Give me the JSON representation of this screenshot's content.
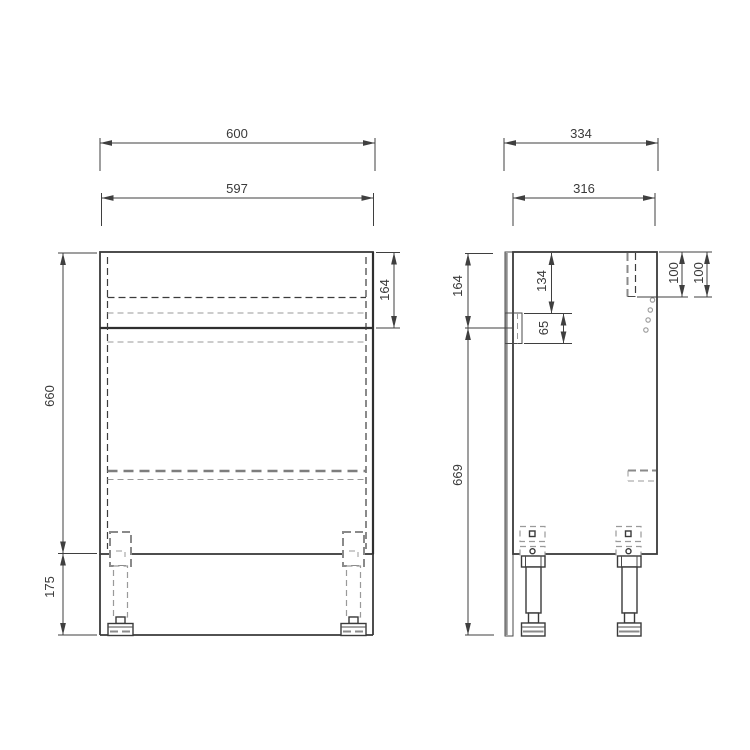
{
  "views": {
    "front": {
      "overall_width": "600",
      "carcass_width": "597",
      "carcass_height": "660",
      "leg_height": "175",
      "drawer_front_height": "164"
    },
    "side": {
      "overall_depth": "334",
      "carcass_depth": "316",
      "drawer_side_height": "164",
      "bracket_top_offset": "134",
      "bracket_height": "65",
      "fixing_offset_a": "100",
      "fixing_offset_b": "100",
      "lower_body_height": "669"
    }
  }
}
